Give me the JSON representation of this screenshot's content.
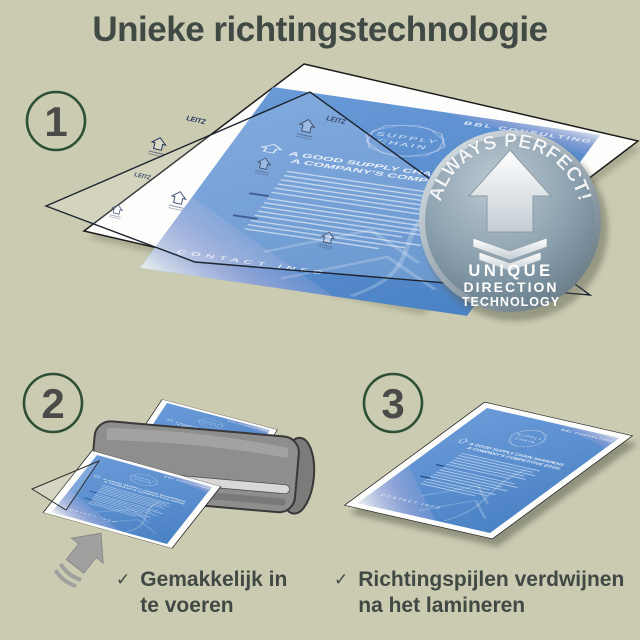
{
  "title": "Unieke richtingstechnologie",
  "steps": [
    {
      "number": "1"
    },
    {
      "number": "2"
    },
    {
      "number": "3"
    }
  ],
  "badge": {
    "arc_text": "ALWAYS PERFECT!",
    "line1": "UNIQUE",
    "line2": "DIRECTION",
    "line3": "TECHNOLOGY"
  },
  "document": {
    "brand": "LEITZ",
    "header": "BBL CONSULTING",
    "logo_line1": "SUPPLY",
    "logo_line2": "CHAIN",
    "heading_line1": "A GOOD SUPPLY CHAIN SHARPENS",
    "heading_line2": "A COMPANY'S COMPETITIVE EDGE.",
    "footer": "CONTACT INFO"
  },
  "captions": [
    {
      "check": "✓",
      "line1": "Gemakkelijk in",
      "line2": "te voeren"
    },
    {
      "check": "✓",
      "line1": "Richtingspijlen verdwijnen",
      "line2": "na het lamineren"
    }
  ],
  "colors": {
    "background": "#cbcbb2",
    "text_dark": "#414944",
    "step_ring_green": "#2d5034",
    "step_number_gray": "#4b4b49",
    "document_blue": "#5b8fd0",
    "badge_steel": "#8ba0af",
    "laminator_gray": "#8e8e8d"
  }
}
